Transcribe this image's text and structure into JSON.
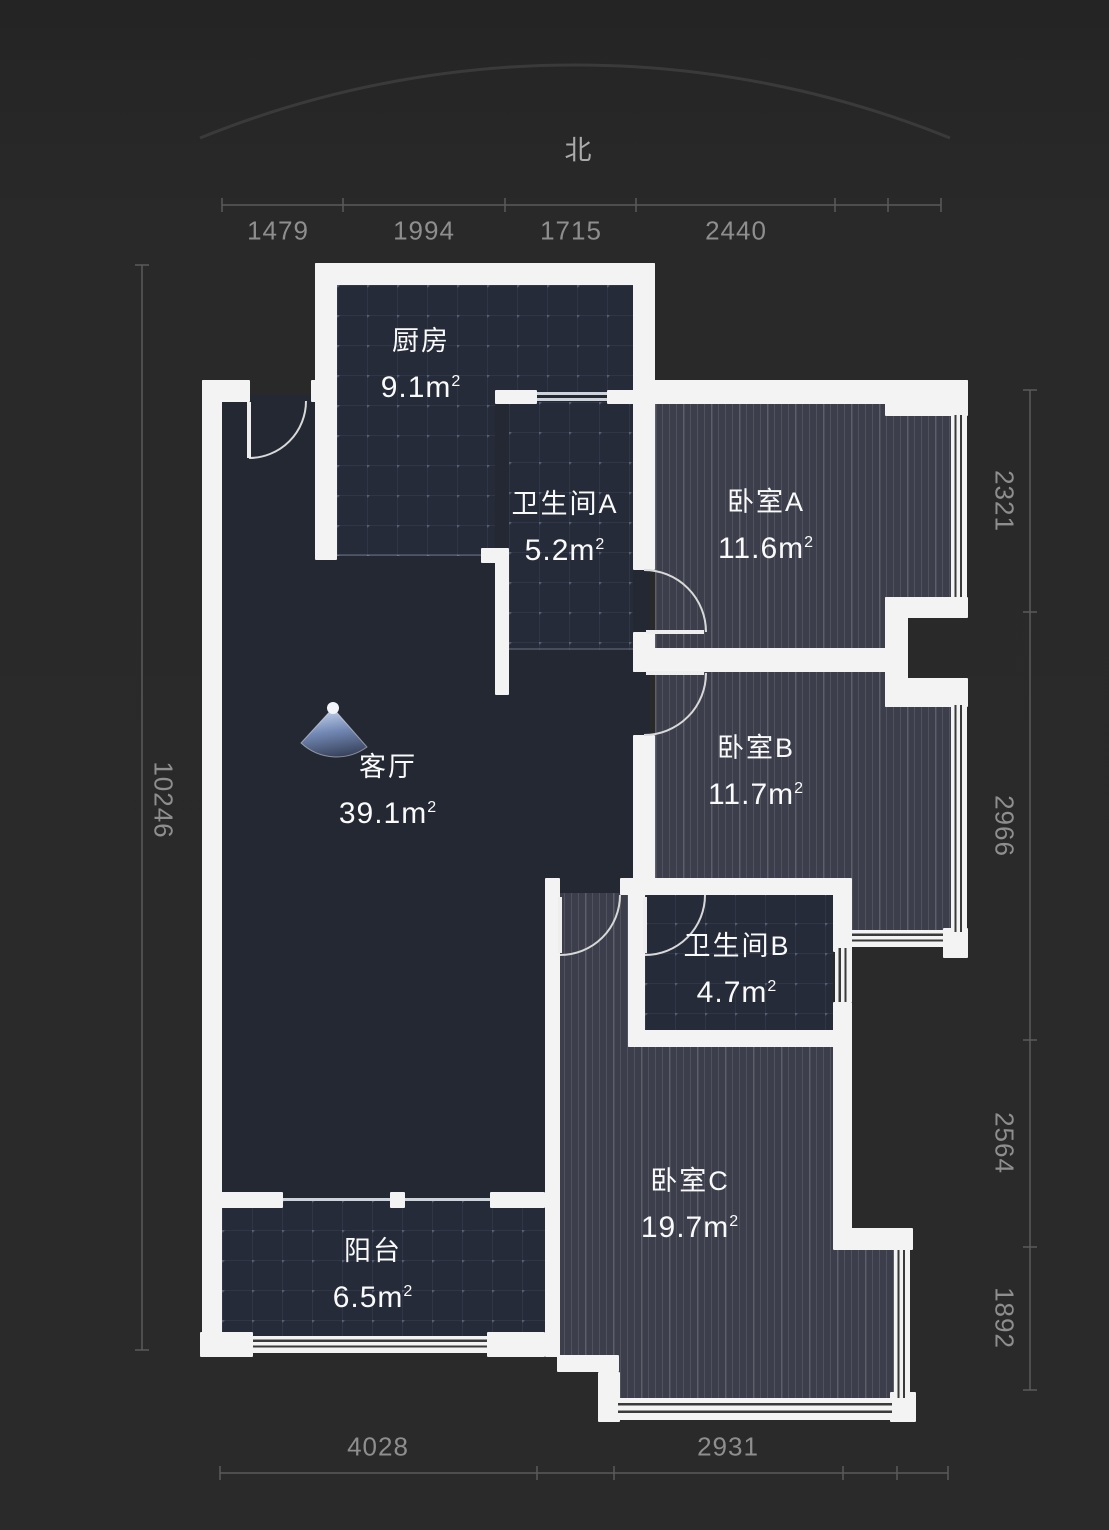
{
  "compass": {
    "label": "北"
  },
  "area_unit": "m",
  "area_sup": "2",
  "rooms": [
    {
      "id": "kitchen",
      "name": "厨房",
      "area": "9.1"
    },
    {
      "id": "bathroom-a",
      "name": "卫生间A",
      "area": "5.2"
    },
    {
      "id": "bedroom-a",
      "name": "卧室A",
      "area": "11.6"
    },
    {
      "id": "living-room",
      "name": "客厅",
      "area": "39.1"
    },
    {
      "id": "bedroom-b",
      "name": "卧室B",
      "area": "11.7"
    },
    {
      "id": "bathroom-b",
      "name": "卫生间B",
      "area": "4.7"
    },
    {
      "id": "bedroom-c",
      "name": "卧室C",
      "area": "19.7"
    },
    {
      "id": "balcony",
      "name": "阳台",
      "area": "6.5"
    }
  ],
  "dimensions": {
    "top": [
      "1479",
      "1994",
      "1715",
      "2440"
    ],
    "bottom": [
      "4028",
      "2931"
    ],
    "left": [
      "10246"
    ],
    "right": [
      "2321",
      "2966",
      "2564",
      "1892"
    ]
  },
  "colors": {
    "background": "#292929",
    "wall": "#f3f3f3",
    "floor_dark": "#242833",
    "floor_tile": "#262b39",
    "floor_wood": "#3c3f4b",
    "dim_text": "#8e8e8e",
    "view_fan_blue": "#7288b4"
  }
}
